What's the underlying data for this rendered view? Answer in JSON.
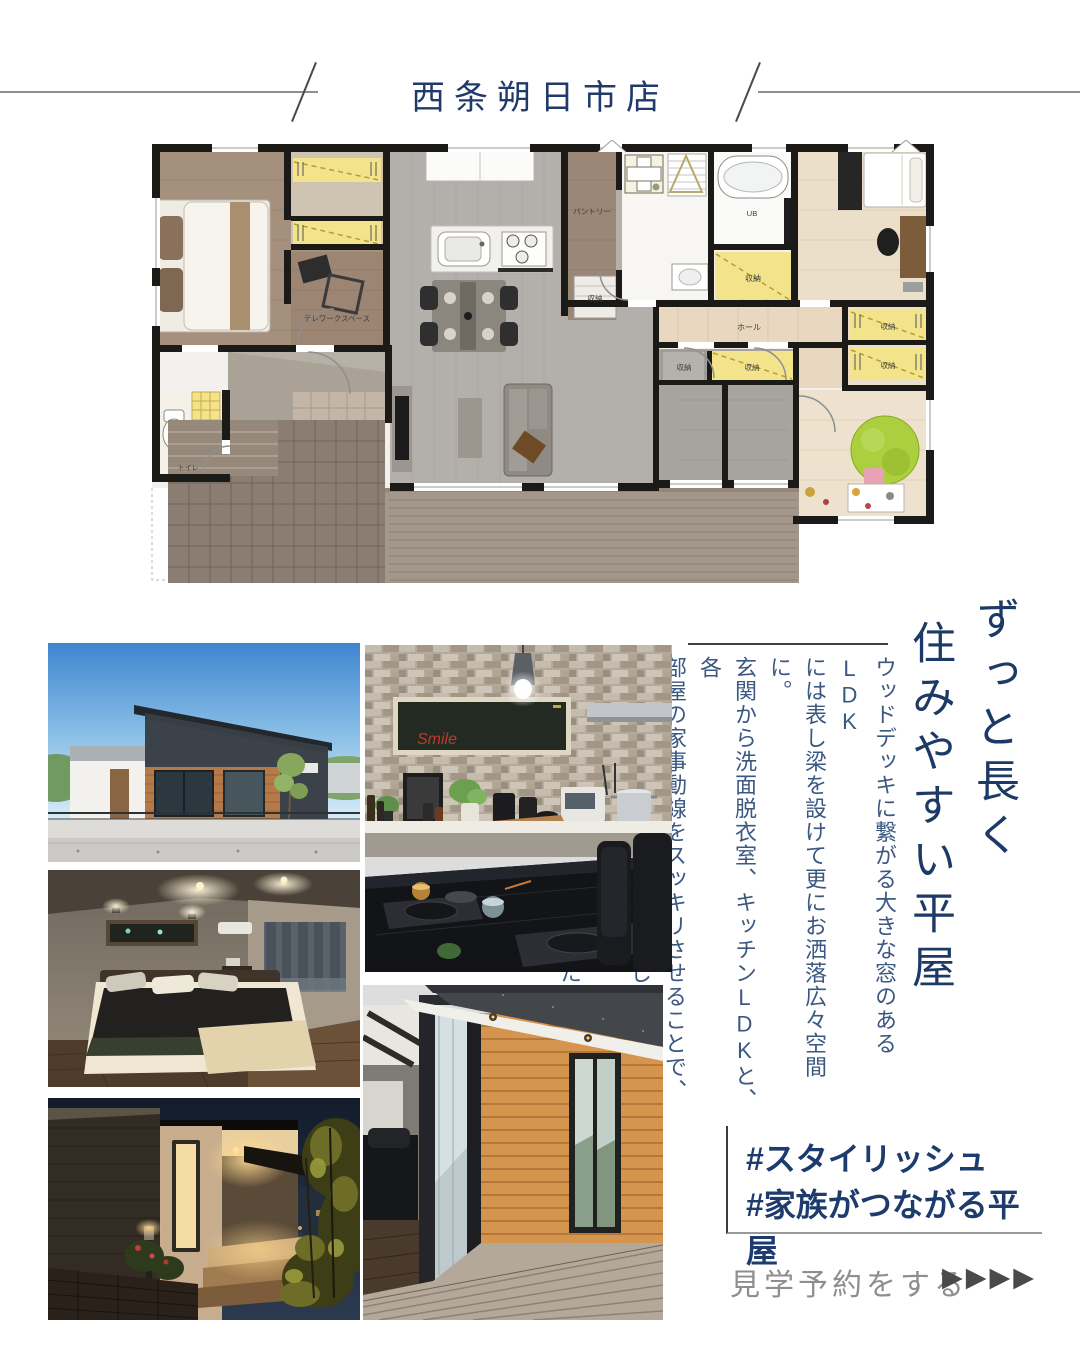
{
  "header": {
    "store_name": "西条朔日市店"
  },
  "title": {
    "line1": "ずっと長く",
    "line2": "住みやすい平屋"
  },
  "body": {
    "lines": [
      "ウッドデッキに繋がる大きな窓のあるLDK",
      "には表し梁を設けて更にお洒落広々空間に。",
      "玄関から洗面脱衣室、キッチンLDKと、各",
      "部屋の家事動線をスッキリさせることで、",
      "個々の生活スタイルを大切にしながら、ママ",
      "の家事楽間取りを実現しました。"
    ]
  },
  "hashtags": {
    "tag1": "#スタイリッシュ",
    "tag2": "#家族がつながる平屋"
  },
  "cta": {
    "label": "見学予約をする",
    "arrows": "▶▶▶▶"
  },
  "photos": {
    "kitchen_sign": "Smile"
  },
  "floor_plan": {
    "labels": {
      "telework": "テレワークスペース",
      "pantry": "パントリー",
      "storage": "収納",
      "hall": "ホール",
      "toilet": "トイレ",
      "bath": "UB"
    }
  },
  "colors": {
    "navy": "#1d3a66",
    "body_text": "#3a5880",
    "cta_gray": "#8e8e8e",
    "arrow_gray": "#4a4a4a"
  }
}
